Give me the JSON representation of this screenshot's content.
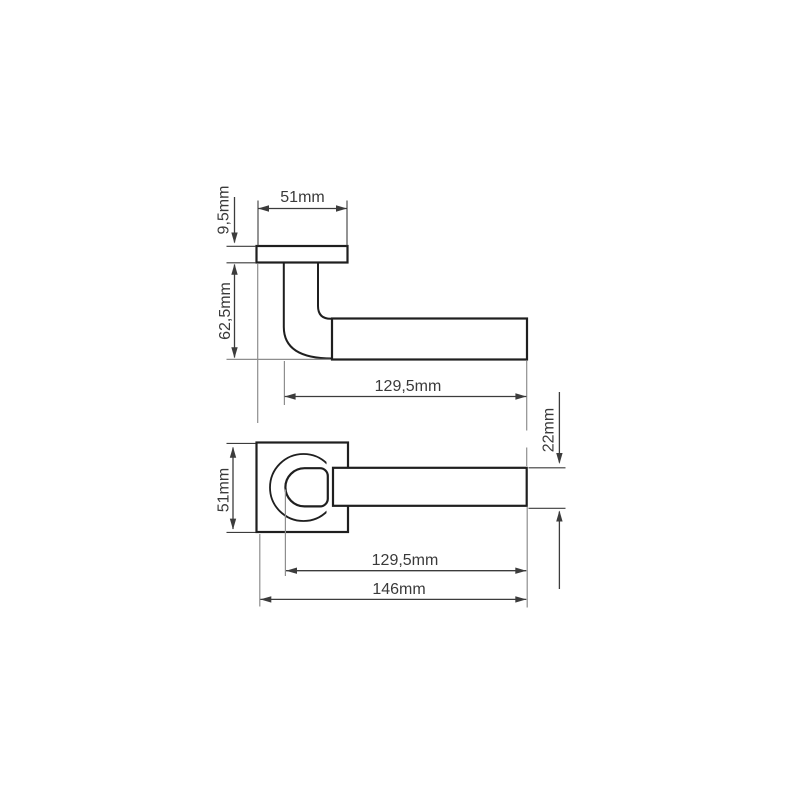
{
  "colors": {
    "background": "#ffffff",
    "object_line": "#1f1f1f",
    "dimension_line": "#3c3c3c",
    "extension_line": "#8e8e8e",
    "label_text": "#3a3a3a"
  },
  "dimensions": {
    "side_view": {
      "rose_width": "51mm",
      "rose_thickness": "9,5mm",
      "handle_height": "62,5mm",
      "lever_length": "129,5mm"
    },
    "front_view": {
      "rose_size": "51mm",
      "lever_thickness": "22mm",
      "lever_length": "129,5mm",
      "overall_length": "146mm"
    }
  }
}
